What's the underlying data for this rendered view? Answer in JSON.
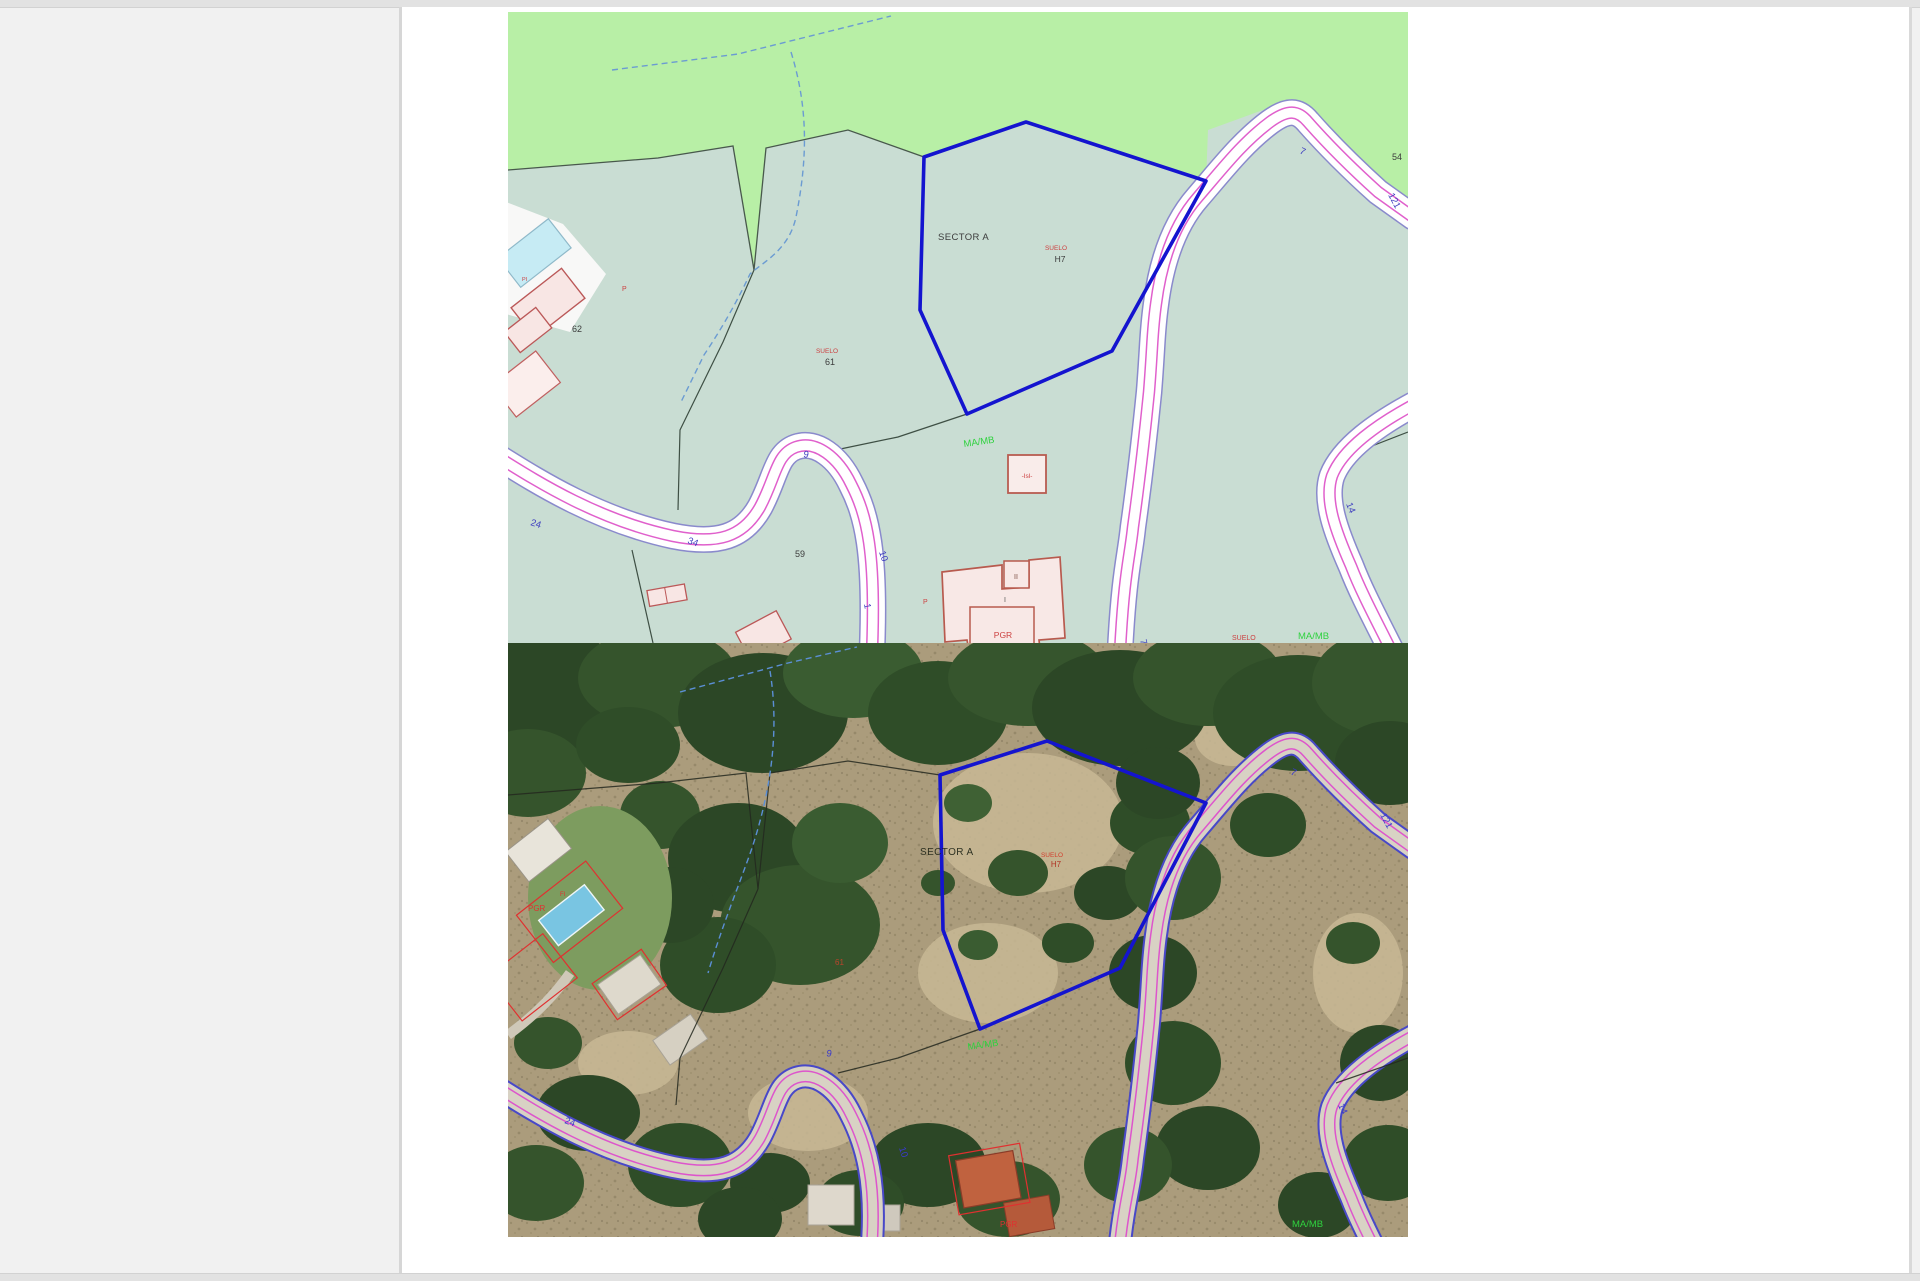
{
  "colors": {
    "veg_green": "#b8efa6",
    "parcel_teal": "#c9ddd3",
    "parcel_blue": "#1414cf",
    "road_edge": "#8a8acc",
    "road_magenta": "#e060cc",
    "label_red": "#cc4040",
    "label_green": "#2fd23f",
    "label_blue": "#4040c0",
    "label_dark": "#3c3c3c",
    "building_fill": "#f8e8e6",
    "building_stroke": "#b85a4e"
  },
  "top_map": {
    "labels": {
      "sector": "SECTOR A",
      "suelo_top": "SUELO",
      "h7": "H7",
      "suelo_61": "SUELO",
      "n61": "61",
      "n62": "62",
      "n59": "59",
      "n54": "54",
      "p_small": "P",
      "pi": "PI",
      "p_house": "P",
      "isl": "-Isl-",
      "ii": "II",
      "i": "I",
      "pgr": "PGR",
      "mamb_mid": "MA/MB",
      "suelo_bottom": "SUELO",
      "mamb_bottom": "MA/MB"
    },
    "roads": {
      "r24": "24",
      "r34": "34",
      "r9": "9",
      "r10": "10",
      "r1": "1",
      "r7_top": "7",
      "r121": "121",
      "r14": "14",
      "r7_bottom": "7"
    }
  },
  "bottom_map": {
    "labels": {
      "sector": "SECTOR A",
      "suelo": "SUELO",
      "h7": "H7",
      "n61": "61",
      "fi": "FI",
      "pgr_left": "PGR",
      "pgr_bottom": "PGR",
      "mamb_mid": "MA/MB",
      "mamb_bottom": "MA/MB"
    },
    "roads": {
      "r24": "24",
      "r9": "9",
      "r10": "10",
      "r7": "7",
      "r14": "14",
      "r121": "121"
    }
  }
}
